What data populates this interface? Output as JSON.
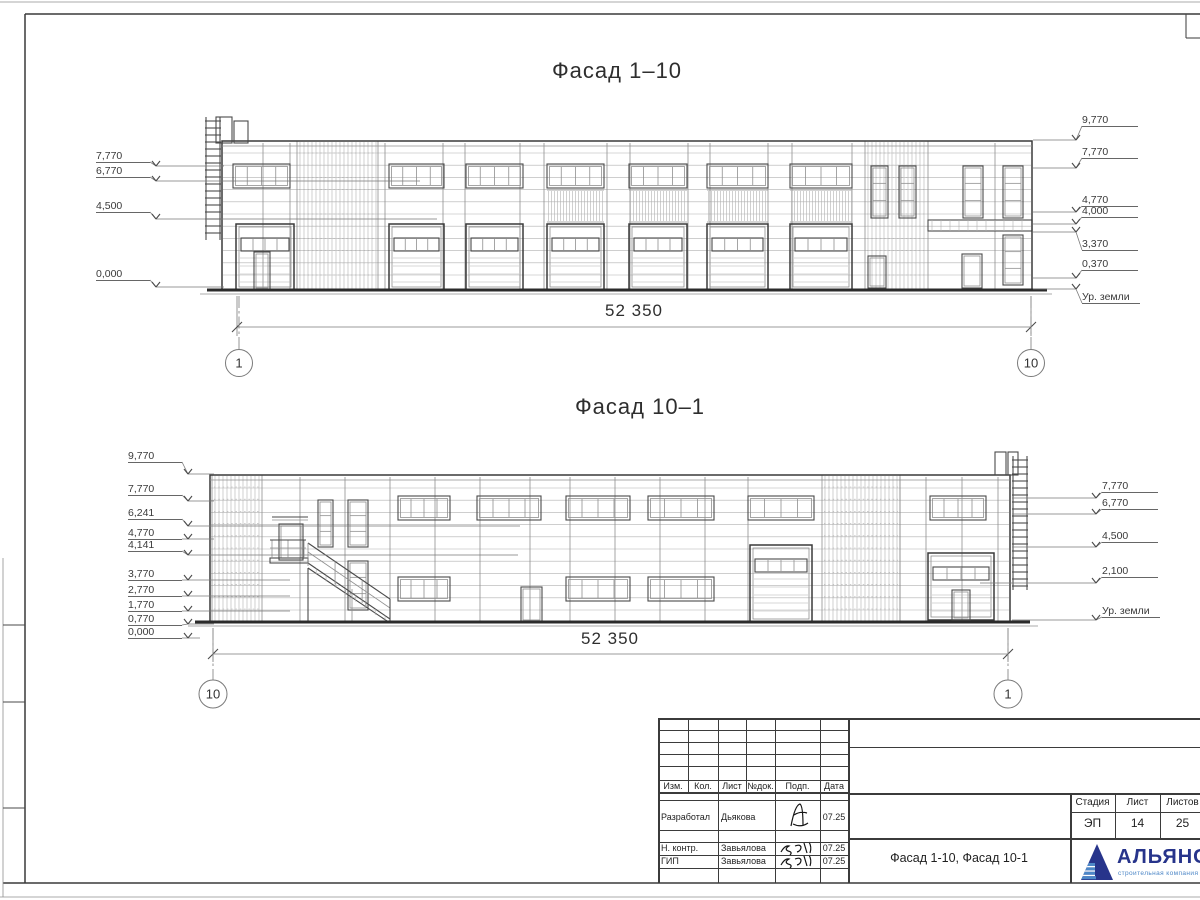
{
  "facade1": {
    "title": "Фасад 1–10",
    "dimension": "52 350",
    "axis_left": "1",
    "axis_right": "10",
    "marks_left": [
      "7,770",
      "6,770",
      "4,500",
      "0,000"
    ],
    "marks_right": [
      "9,770",
      "7,770",
      "4,770",
      "4,000",
      "3,370",
      "0,370"
    ],
    "ground_label": "Ур. земли"
  },
  "facade2": {
    "title": "Фасад 10–1",
    "dimension": "52 350",
    "axis_left": "10",
    "axis_right": "1",
    "marks_left": [
      "9,770",
      "7,770",
      "6,241",
      "4,770",
      "4,141",
      "3,770",
      "2,770",
      "1,770",
      "0,770",
      "0,000"
    ],
    "marks_right": [
      "7,770",
      "6,770",
      "4,500",
      "2,100"
    ],
    "ground_label": "Ур. земли"
  },
  "titleblock": {
    "cols": [
      "Изм.",
      "Кол.",
      "Лист",
      "№док.",
      "Подп.",
      "Дата"
    ],
    "rows": [
      {
        "role": "Разработал",
        "name": "Дьякова",
        "date": "07.25"
      },
      {
        "role": "Н. контр.",
        "name": "Завьялова",
        "date": "07.25"
      },
      {
        "role": "ГИП",
        "name": "Завьялова",
        "date": "07.25"
      }
    ],
    "doc_title": "Фасад 1-10, Фасад 10-1",
    "stage_label": "Стадия",
    "sheet_label": "Лист",
    "sheets_label": "Листов",
    "stage": "ЭП",
    "sheet": "14",
    "sheets": "25",
    "logo_name": "АЛЬЯНС",
    "logo_subtitle": "строительная компания",
    "logo_color": "#27348b",
    "logo_accent": "#4d87c7"
  }
}
